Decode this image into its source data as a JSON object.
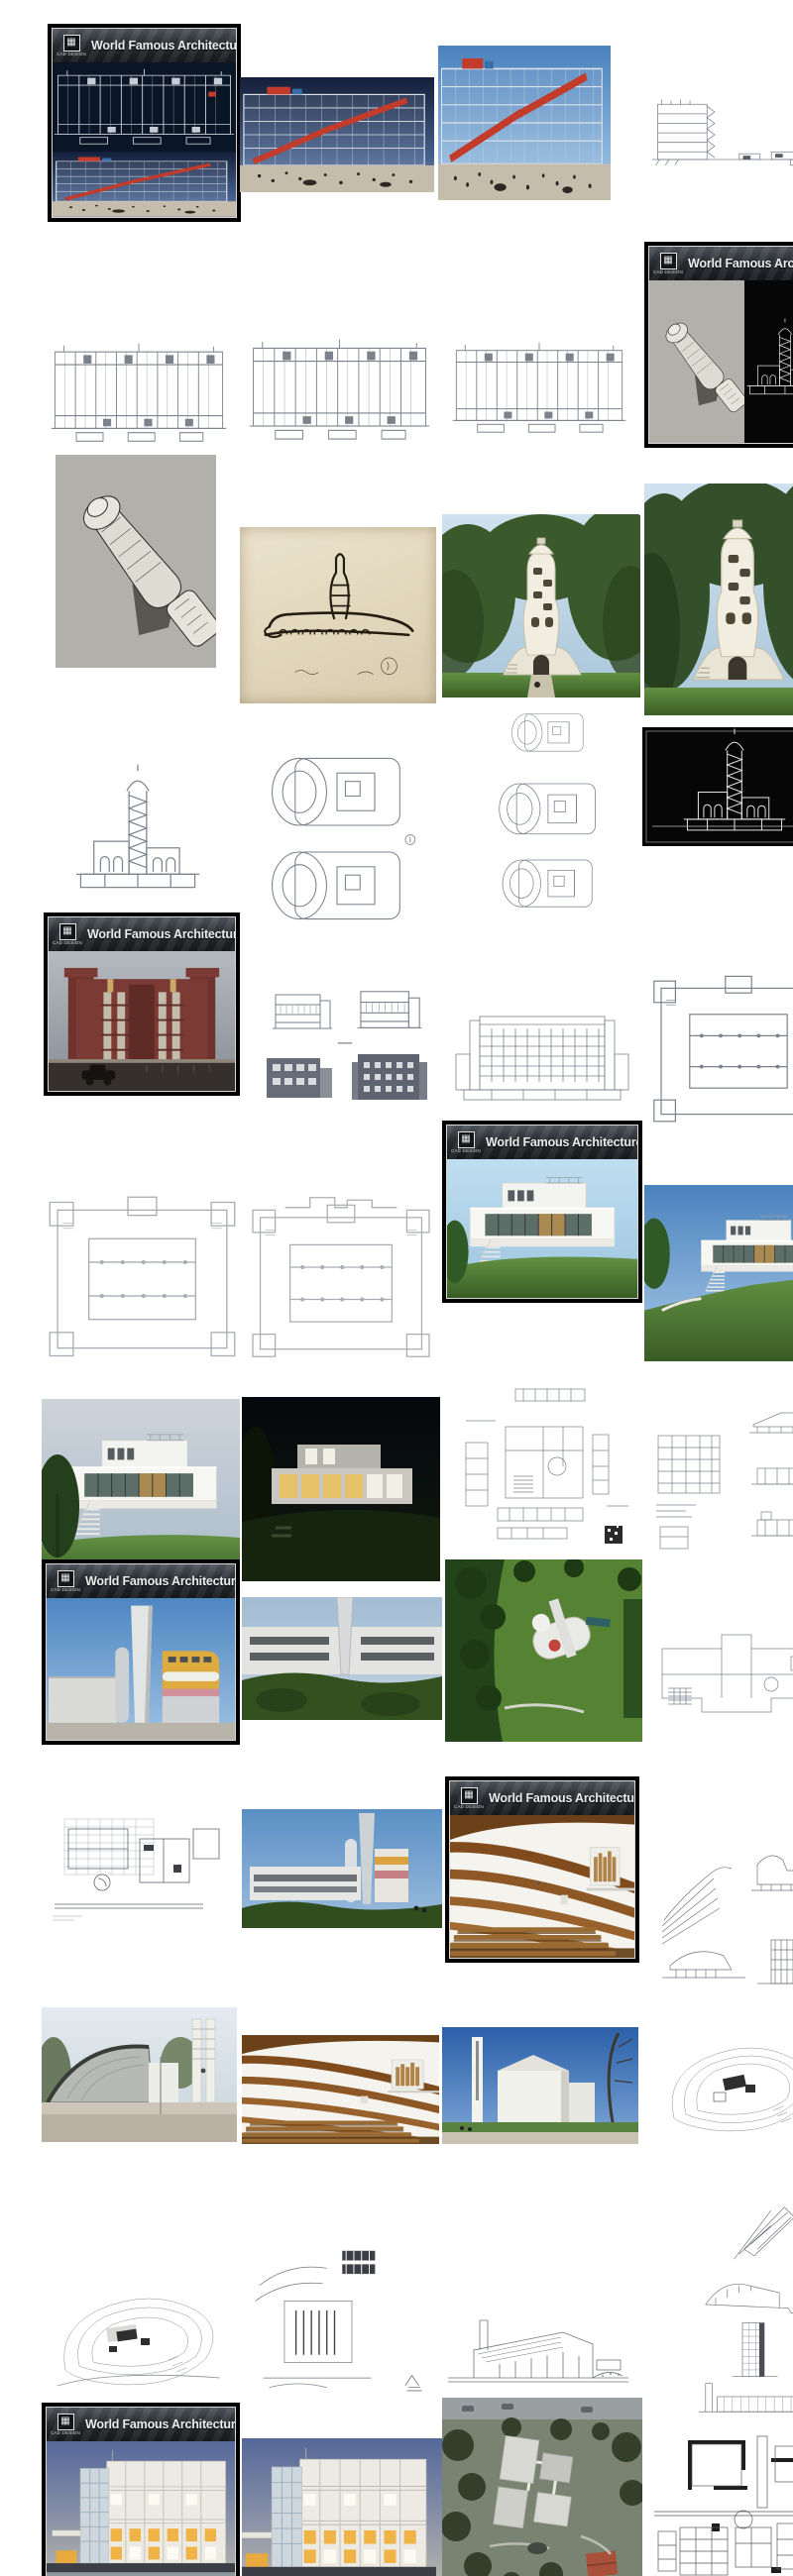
{
  "branding": {
    "banner_title": "World Famous Architecture",
    "logo_caption": "CAD DESIGN",
    "logo_icon": "crest-icon"
  },
  "palette": {
    "cover_frame": "#000000",
    "cover_inner_line": "#d6d6d6",
    "banner_bg": "#2a2e33",
    "banner_text": "#ececec",
    "pompidou_red": "#c23b2b",
    "cad_navy": "#0a1526",
    "brick_red": "#7b3a33",
    "grass_green": "#4e7c3b",
    "sky_day": "#4a82bd",
    "sky_dusk": "#141f3a",
    "wood_brown": "#8a5425",
    "window_glow": "#f0b345",
    "line_art_gray": "#7b828c",
    "wallhouse_yellow": "#ddab3e"
  },
  "gallery": {
    "items": [
      {
        "id": "cover-pompidou",
        "kind": "cover",
        "subject": "Cover card: Centre Pompidou CAD elevation on navy over dusk photo"
      },
      {
        "id": "pompidou-photo-dusk",
        "kind": "photo",
        "subject": "Centre Pompidou facade at dusk with red escalator and plaza crowd"
      },
      {
        "id": "pompidou-photo-day",
        "kind": "photo",
        "subject": "Centre Pompidou escalator facade daytime with plaza crowd"
      },
      {
        "id": "pompidou-section-drawing",
        "kind": "drawing",
        "subject": "Centre Pompidou section line drawing with long ground line"
      },
      {
        "id": "pompidou-elevation-1",
        "kind": "drawing",
        "subject": "Centre Pompidou elevation CAD drawing"
      },
      {
        "id": "pompidou-elevation-2",
        "kind": "drawing",
        "subject": "Centre Pompidou elevation CAD drawing"
      },
      {
        "id": "pompidou-elevation-3",
        "kind": "drawing",
        "subject": "Centre Pompidou elevation CAD drawing"
      },
      {
        "id": "cover-einstein",
        "kind": "cover",
        "subject": "Cover card: Einstein Tower axonometric on gray and white CAD section on black"
      },
      {
        "id": "einstein-axonometric",
        "kind": "drawing",
        "subject": "Einstein Tower cutaway axonometric drawing on gray paper"
      },
      {
        "id": "einstein-sketch",
        "kind": "sketch",
        "subject": "Einstein Tower concept ink sketch on cream paper"
      },
      {
        "id": "einstein-photo-trees",
        "kind": "photo",
        "subject": "Einstein Tower white curved observatory among trees"
      },
      {
        "id": "einstein-photo-large",
        "kind": "photo",
        "subject": "Einstein Tower white stucco exterior close view"
      },
      {
        "id": "einstein-section-elevation",
        "kind": "drawing",
        "subject": "Einstein Tower section and elevation line drawing"
      },
      {
        "id": "einstein-floor-plans",
        "kind": "drawing",
        "subject": "Einstein Tower floor plans, two stacked"
      },
      {
        "id": "einstein-small-plans",
        "kind": "drawing",
        "subject": "Einstein Tower level plans, three stacked"
      },
      {
        "id": "einstein-black-cad",
        "kind": "drawing",
        "subject": "Einstein Tower CAD section, white lines on black"
      },
      {
        "id": "cover-larkin",
        "kind": "cover",
        "subject": "Cover card: red brick Larkin Building photo with vintage car"
      },
      {
        "id": "larkin-small-elevations",
        "kind": "drawing",
        "subject": "Four small elevation studies, two outline and two shaded"
      },
      {
        "id": "larkin-elevation-cad",
        "kind": "drawing",
        "subject": "Larkin Building elevation CAD drawing with window grid"
      },
      {
        "id": "larkin-plan-1",
        "kind": "drawing",
        "subject": "Larkin Building floor plan with corner pods and column rows"
      },
      {
        "id": "larkin-plan-2",
        "kind": "drawing",
        "subject": "Larkin Building floor plan, light lines"
      },
      {
        "id": "larkin-plan-3",
        "kind": "drawing",
        "subject": "Larkin Building floor plan variant with top extension"
      },
      {
        "id": "cover-tugendhat",
        "kind": "cover",
        "subject": "Cover card: white modernist villa render on grass hill"
      },
      {
        "id": "tugendhat-render-hill",
        "kind": "render",
        "subject": "White villa render seen across hillside lawn"
      },
      {
        "id": "tugendhat-render-day",
        "kind": "render",
        "subject": "White villa garden facade render with terrace and stair"
      },
      {
        "id": "tugendhat-render-night",
        "kind": "render",
        "subject": "White villa night render with warm lit glass wall"
      },
      {
        "id": "tugendhat-cad-sheet",
        "kind": "drawing",
        "subject": "CAD sheet with plan, sections and small code block"
      },
      {
        "id": "tugendhat-plan-sheet",
        "kind": "drawing",
        "subject": "Small floor plan sheet"
      },
      {
        "id": "tugendhat-elevation-stack",
        "kind": "drawing",
        "subject": "Column of small section studies with code block"
      },
      {
        "id": "cover-wallhouse",
        "kind": "cover",
        "subject": "Cover card: building with tall white blade wall and yellow curved volumes"
      },
      {
        "id": "wallhouse-photo",
        "kind": "photo",
        "subject": "Street view of white building band with blade wall and greenery"
      },
      {
        "id": "wallhouse-aerial",
        "kind": "photo",
        "subject": "Aerial view of curved white building on green lawn"
      },
      {
        "id": "wallhouse-plan",
        "kind": "drawing",
        "subject": "Floor plan with hatched stair grid"
      },
      {
        "id": "wallhouse-plan-cad",
        "kind": "drawing",
        "subject": "Plan CAD drawing with dense structural grid"
      },
      {
        "id": "wallhouse-photo-2",
        "kind": "photo",
        "subject": "Blade wall, silo and colored facade against blue sky"
      },
      {
        "id": "cover-riola",
        "kind": "cover",
        "subject": "Cover card: church interior with curved wooden ribs and pews"
      },
      {
        "id": "riola-section-sketches",
        "kind": "sketch",
        "subject": "Church section and perspective concept sketches"
      },
      {
        "id": "riola-exterior",
        "kind": "photo",
        "subject": "Church exterior with curved gray shell and slatted campanile"
      },
      {
        "id": "riola-interior",
        "kind": "photo",
        "subject": "Church nave interior with wood rib ceiling, organ and pews"
      },
      {
        "id": "riola-exterior-white",
        "kind": "photo",
        "subject": "White stepped church volumes and thin campanile against deep blue sky"
      },
      {
        "id": "riola-site-sketch",
        "kind": "sketch",
        "subject": "Site plan sketch with contour loops and dark building blob"
      },
      {
        "id": "sketch-site-contours",
        "kind": "sketch",
        "subject": "Hillside site sketch with contour lines"
      },
      {
        "id": "sketch-site-building",
        "kind": "sketch",
        "subject": "Site sketch with hatched building plan and road curves"
      },
      {
        "id": "sketch-tiny",
        "kind": "sketch",
        "subject": "Tiny thumbnail scribble"
      },
      {
        "id": "sketch-long-section",
        "kind": "sketch",
        "subject": "Long site section sketch with sloped roof lines"
      },
      {
        "id": "sketch-stack",
        "kind": "sketch",
        "subject": "Column of four small concept sketches"
      },
      {
        "id": "cover-meier",
        "kind": "cover",
        "subject": "Cover card: white gridded museum facade at dusk with lit windows"
      },
      {
        "id": "meier-photo-dusk",
        "kind": "photo",
        "subject": "White grid facade with warm lit windows at dusk"
      },
      {
        "id": "meier-aerial",
        "kind": "photo",
        "subject": "Aerial view of white museum blocks, gardens and red roof house"
      },
      {
        "id": "meier-plan",
        "kind": "drawing",
        "subject": "Museum floor plan with black poche walls"
      }
    ]
  }
}
